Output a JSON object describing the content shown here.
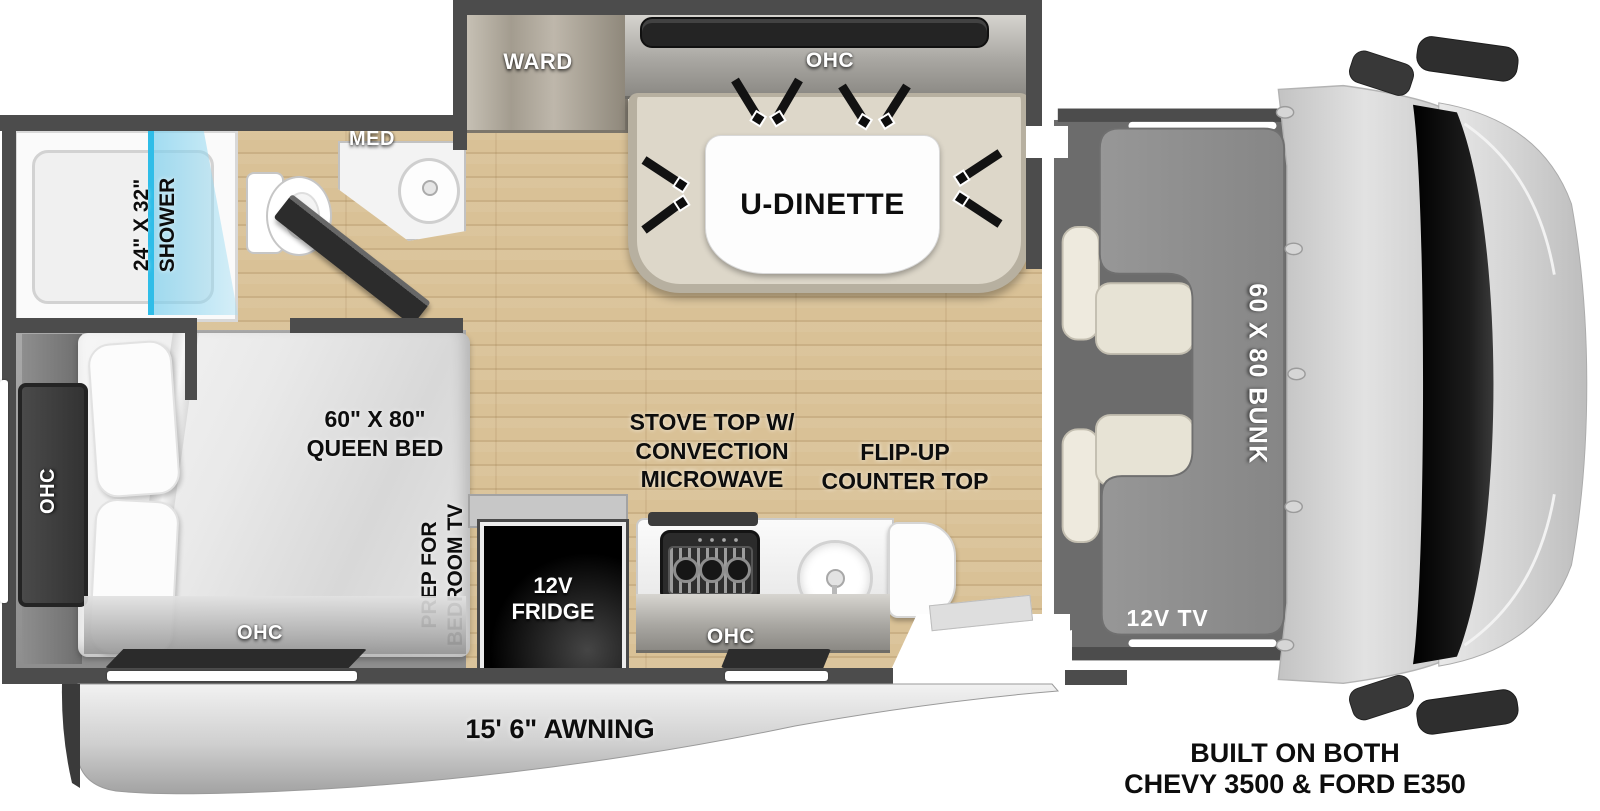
{
  "title": "RV floorplan diagram",
  "floorplan": {
    "bathroom": {
      "shower_size_label": "24\" X 32\"",
      "shower_label": "SHOWER",
      "med_cabinet_label": "MED"
    },
    "wardrobe_label": "WARD",
    "dinette": {
      "overhead_cabinet_label": "OHC",
      "table_label": "U-DINETTE"
    },
    "bedroom": {
      "bed_size_label": "60\" X 80\"",
      "bed_label": "QUEEN BED",
      "tv_prep_line1": "PREP FOR",
      "tv_prep_line2": "BEDROOM TV",
      "overhead_cabinet_left_label": "OHC",
      "overhead_cabinet_foot_label": "OHC"
    },
    "kitchen": {
      "fridge_line1": "12V",
      "fridge_line2": "FRIDGE",
      "stove_line1": "STOVE TOP W/",
      "stove_line2": "CONVECTION",
      "stove_line3": "MICROWAVE",
      "counter_line1": "FLIP-UP",
      "counter_line2": "COUNTER TOP",
      "overhead_cabinet_label": "OHC"
    },
    "cab": {
      "bunk_label": "60 X 80 BUNK",
      "tv_label": "12V TV"
    },
    "exterior": {
      "awning_label": "15' 6\" AWNING",
      "chassis_line1": "BUILT ON BOTH",
      "chassis_line2": "CHEVY 3500 & FORD E350"
    },
    "colors": {
      "wall": "#4c4c4c",
      "wood_floor": "#d9c196",
      "bedroom_floor": "#9a9a9a",
      "shower_glass": "#49c3ec",
      "dinette_bench": "#ddd7c9",
      "bunk": "#8e8e8e",
      "awning": "#c7c7c7"
    }
  }
}
